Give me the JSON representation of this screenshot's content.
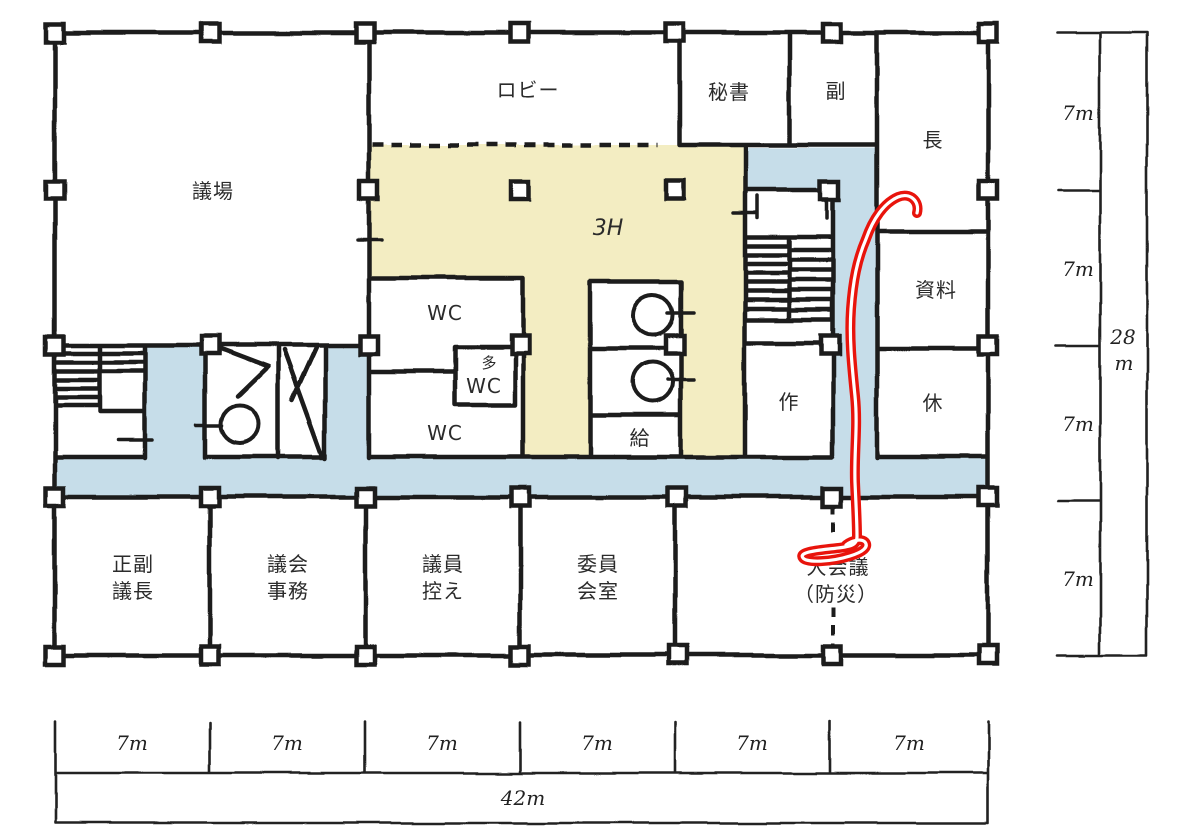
{
  "title": "hand-drawn council floor plan with red marker route",
  "rooms": {
    "gijo": "議場",
    "lobby": "ロビー",
    "hisho": "秘書",
    "fuku": "副",
    "cho": "長",
    "shiryo": "資料",
    "kyu": "休",
    "saku": "作",
    "hall": "3H",
    "wc_north": "WC",
    "wc_multi_mark": "多",
    "wc_multi": "WC",
    "wc_south": "WC",
    "kyuto": "給",
    "seifuku": [
      "正副",
      "議長"
    ],
    "gikai": [
      "議会",
      "事務"
    ],
    "giin": [
      "議員",
      "控え"
    ],
    "iin": [
      "委員",
      "会室"
    ],
    "daikaigi": [
      "大会議",
      "（防災）"
    ]
  },
  "dims": {
    "horizontal": [
      "7m",
      "7m",
      "7m",
      "7m",
      "7m",
      "7m"
    ],
    "horizontal_total": "42m",
    "vertical": [
      "7m",
      "7m",
      "7m",
      "7m"
    ],
    "vertical_total": [
      "28",
      "m"
    ]
  },
  "colors": {
    "wall": "#1b1b1b",
    "hall_yellow": "#f3edc2",
    "corridor_blue": "#c6dde9",
    "route_red": "#e8140c",
    "route_core": "#ffffff",
    "paper": "#ffffff"
  }
}
